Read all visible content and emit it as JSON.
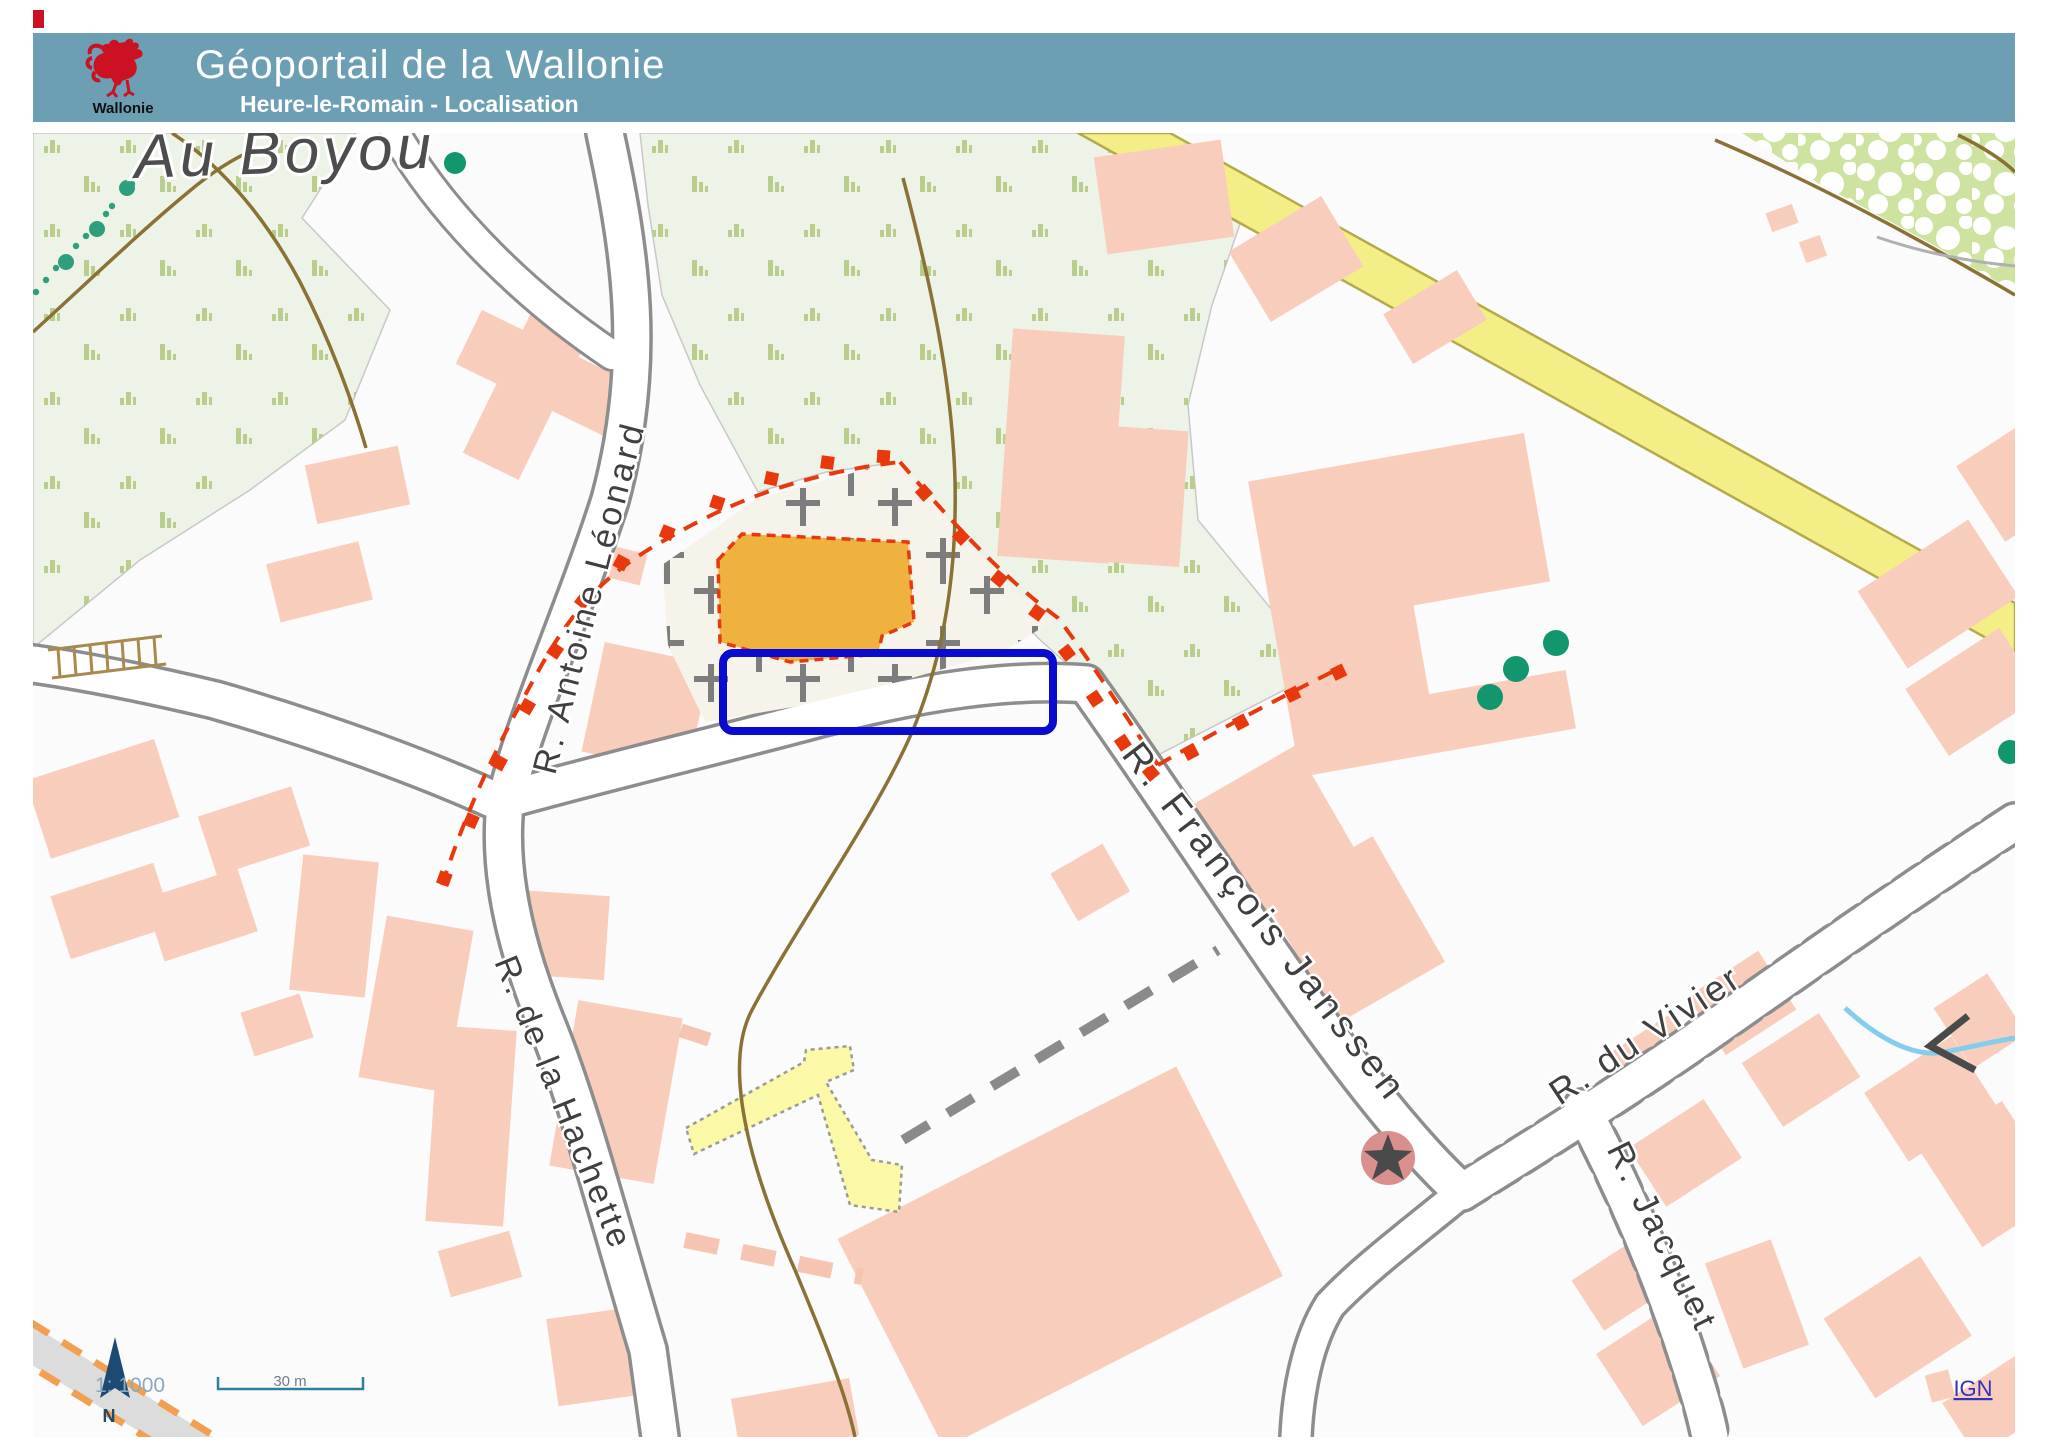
{
  "header": {
    "logo_text": "Wallonie",
    "title": "Géoportail de la Wallonie",
    "subtitle": "Heure-le-Romain - Localisation",
    "bg_color": "#6c9fb4",
    "logo_red": "#cc1222"
  },
  "map": {
    "place_label": "Au Boyou",
    "streets": [
      {
        "name": "R. Antoine Léonard"
      },
      {
        "name": "R. de la Hachette"
      },
      {
        "name": "R. François Janssen"
      },
      {
        "name": "R. du Vivier"
      },
      {
        "name": "R. Jacquet"
      }
    ],
    "scale": {
      "ratio": "1: 1000",
      "bar_label": "30 m",
      "north_label": "N"
    },
    "attribution": {
      "label": "IGN"
    },
    "highlight_color": "#0b0bcf",
    "colors": {
      "building": "#f8cdbb",
      "cemetery": "#f6f4ea",
      "church": "#f0b23f",
      "parcel_boundary": "#e8380d",
      "vegetation": "#eef3e7",
      "orchard": "#cfe3a0",
      "major_road": "#f4ee86",
      "contour": "#8a7136",
      "water": "#85cdec",
      "road_casing": "#8d8d8d"
    }
  }
}
